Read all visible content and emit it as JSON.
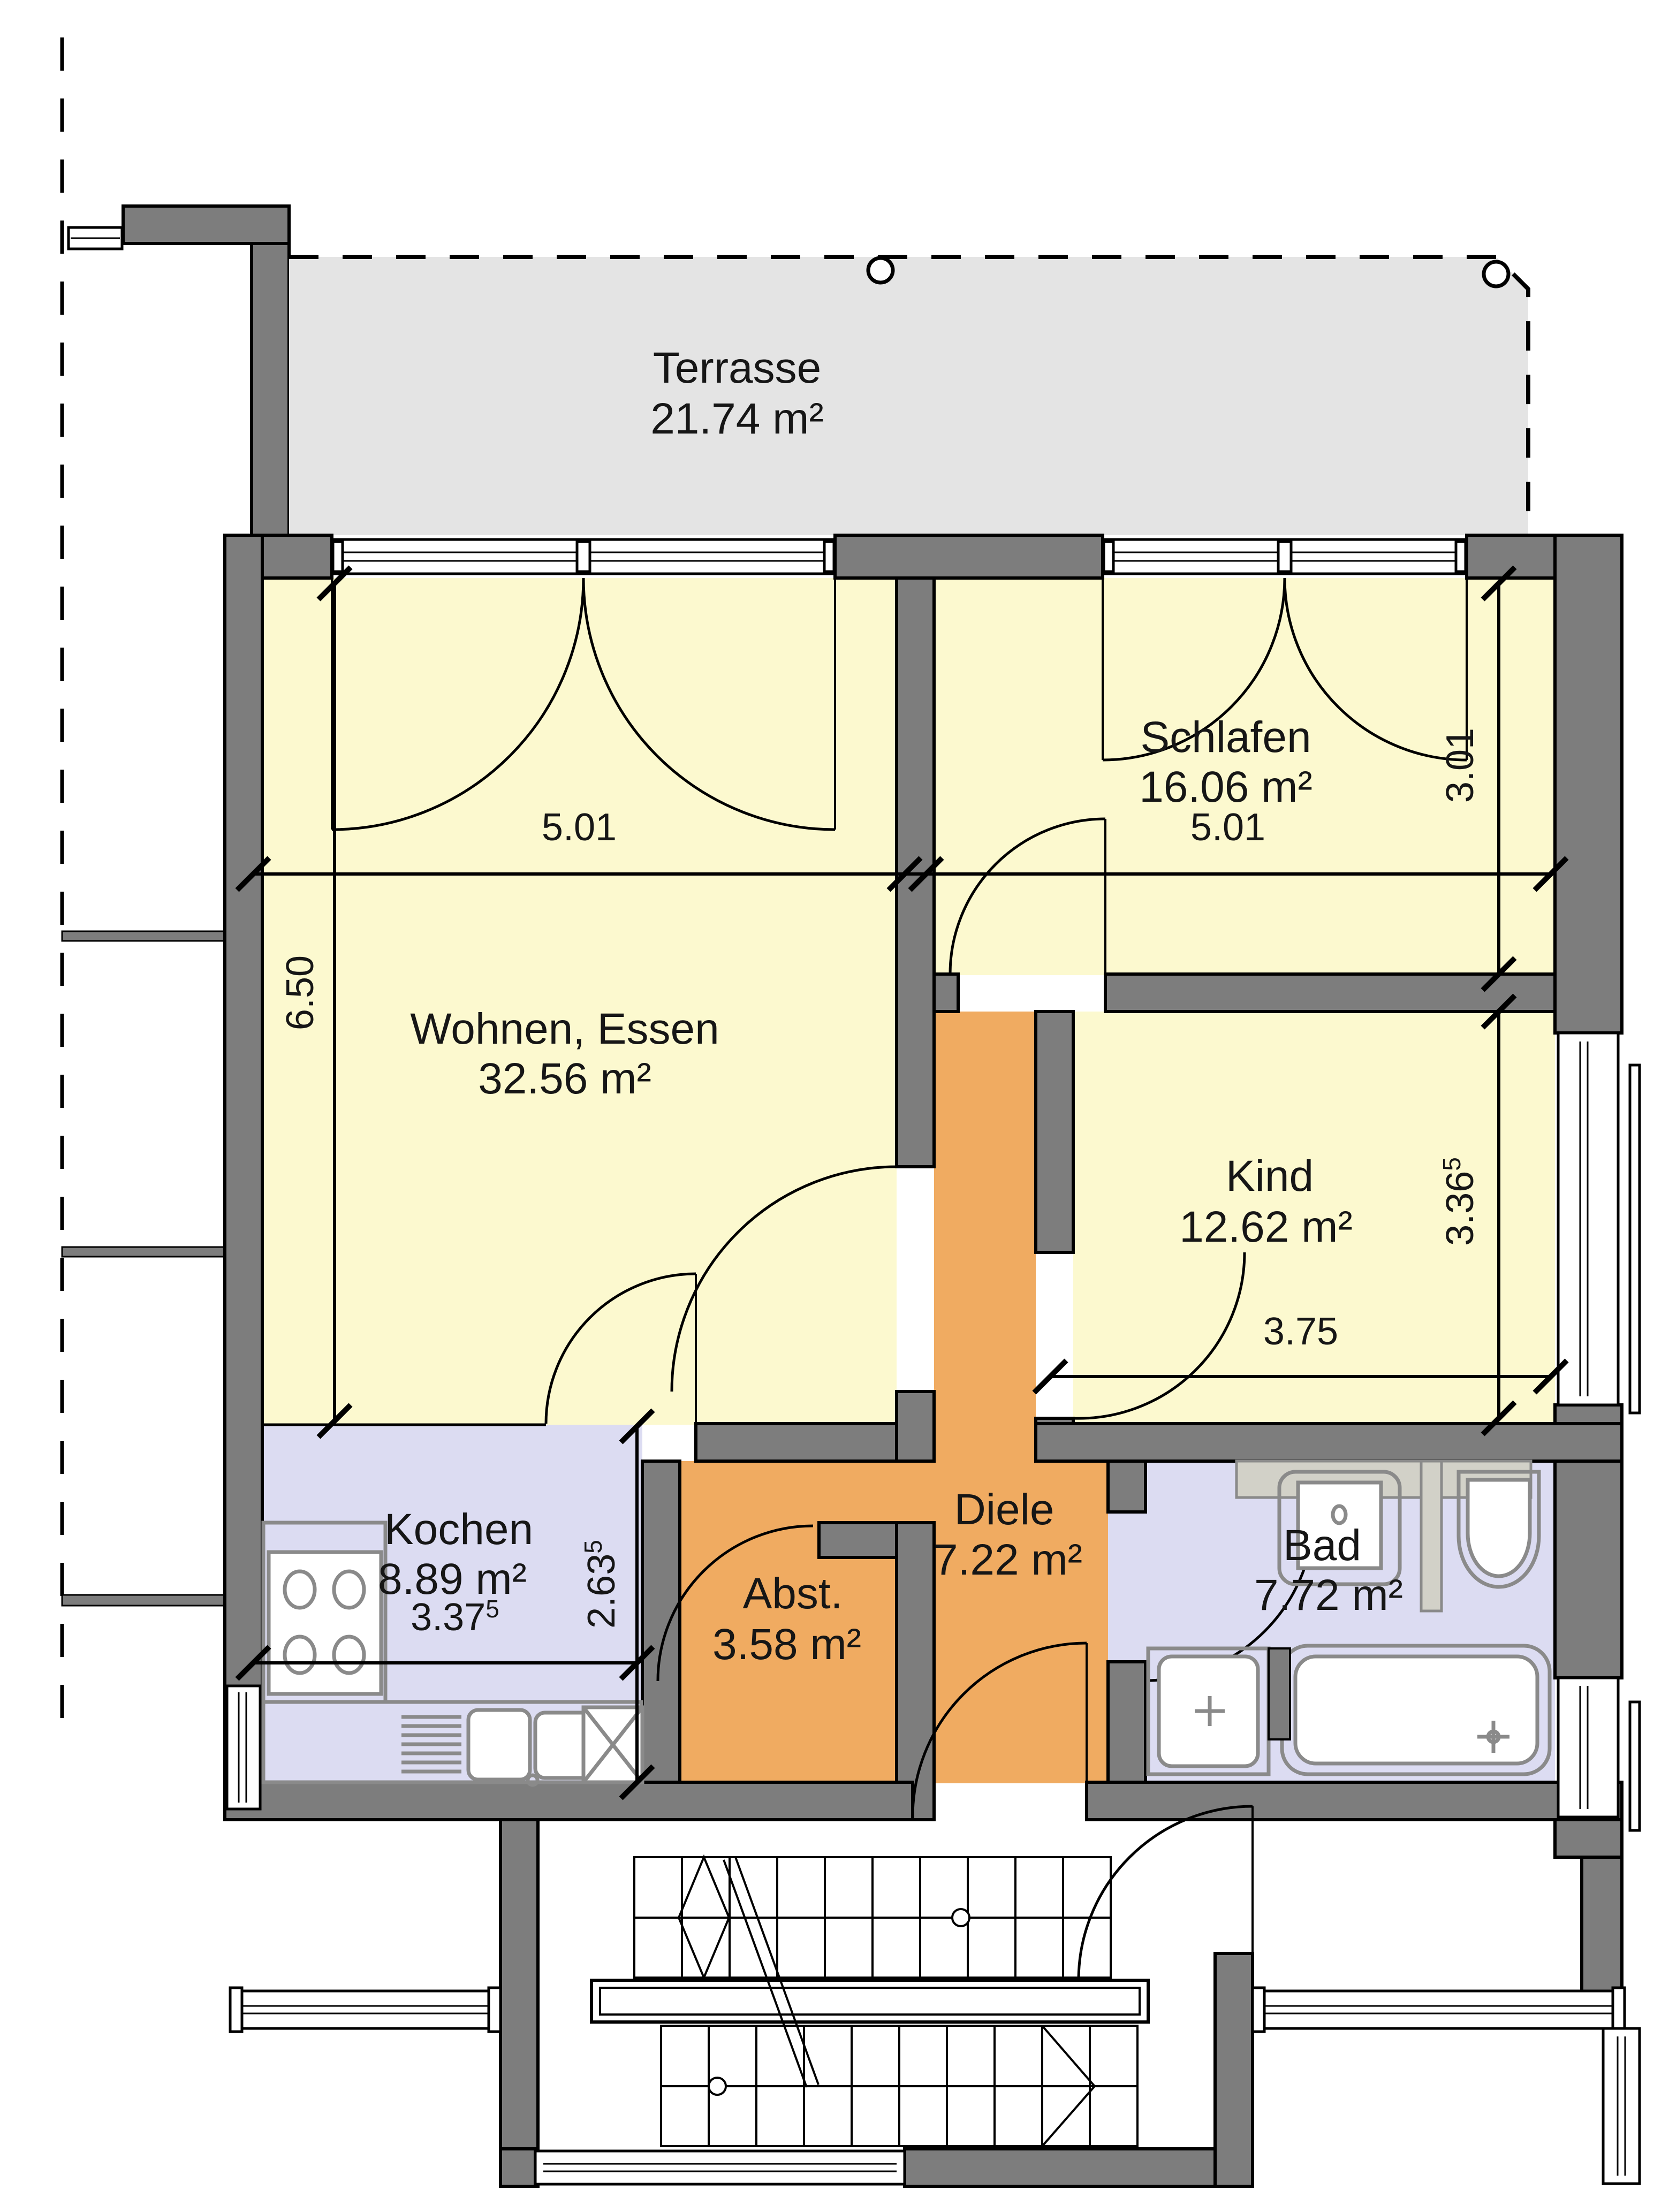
{
  "plan_type": "floor-plan",
  "colors": {
    "wall": "#7d7d7d",
    "room_yellow": "#fcf9cf",
    "room_lavender": "#dcdcf2",
    "room_orange": "#f0ab61",
    "terrace_gray": "#e4e4e4",
    "line": "#000000"
  },
  "rooms": {
    "terrasse": {
      "label": "Terrasse",
      "area": "21.74 m²"
    },
    "schlafen": {
      "label": "Schlafen",
      "area": "16.06 m²"
    },
    "wohnen": {
      "label": "Wohnen, Essen",
      "area": "32.56 m²"
    },
    "kind": {
      "label": "Kind",
      "area": "12.62 m²"
    },
    "kochen": {
      "label": "Kochen",
      "area": "8.89 m²"
    },
    "abstellraum": {
      "label": "Abst.",
      "area": "3.58 m²"
    },
    "diele": {
      "label": "Diele",
      "area": "7.22 m²"
    },
    "bad": {
      "label": "Bad",
      "area": "7.72 m²"
    }
  },
  "dimensions": {
    "wohnen_width": "5.01",
    "schlafen_width": "5.01",
    "wohnen_depth": "6.50",
    "schlafen_depth": "3.01",
    "kind_depth": "3.36",
    "kind_depth_sup": "5",
    "kind_width": "3.75",
    "kochen_width": "3.37",
    "kochen_width_sup": "5",
    "kochen_depth": "2.63",
    "kochen_depth_sup": "5"
  }
}
